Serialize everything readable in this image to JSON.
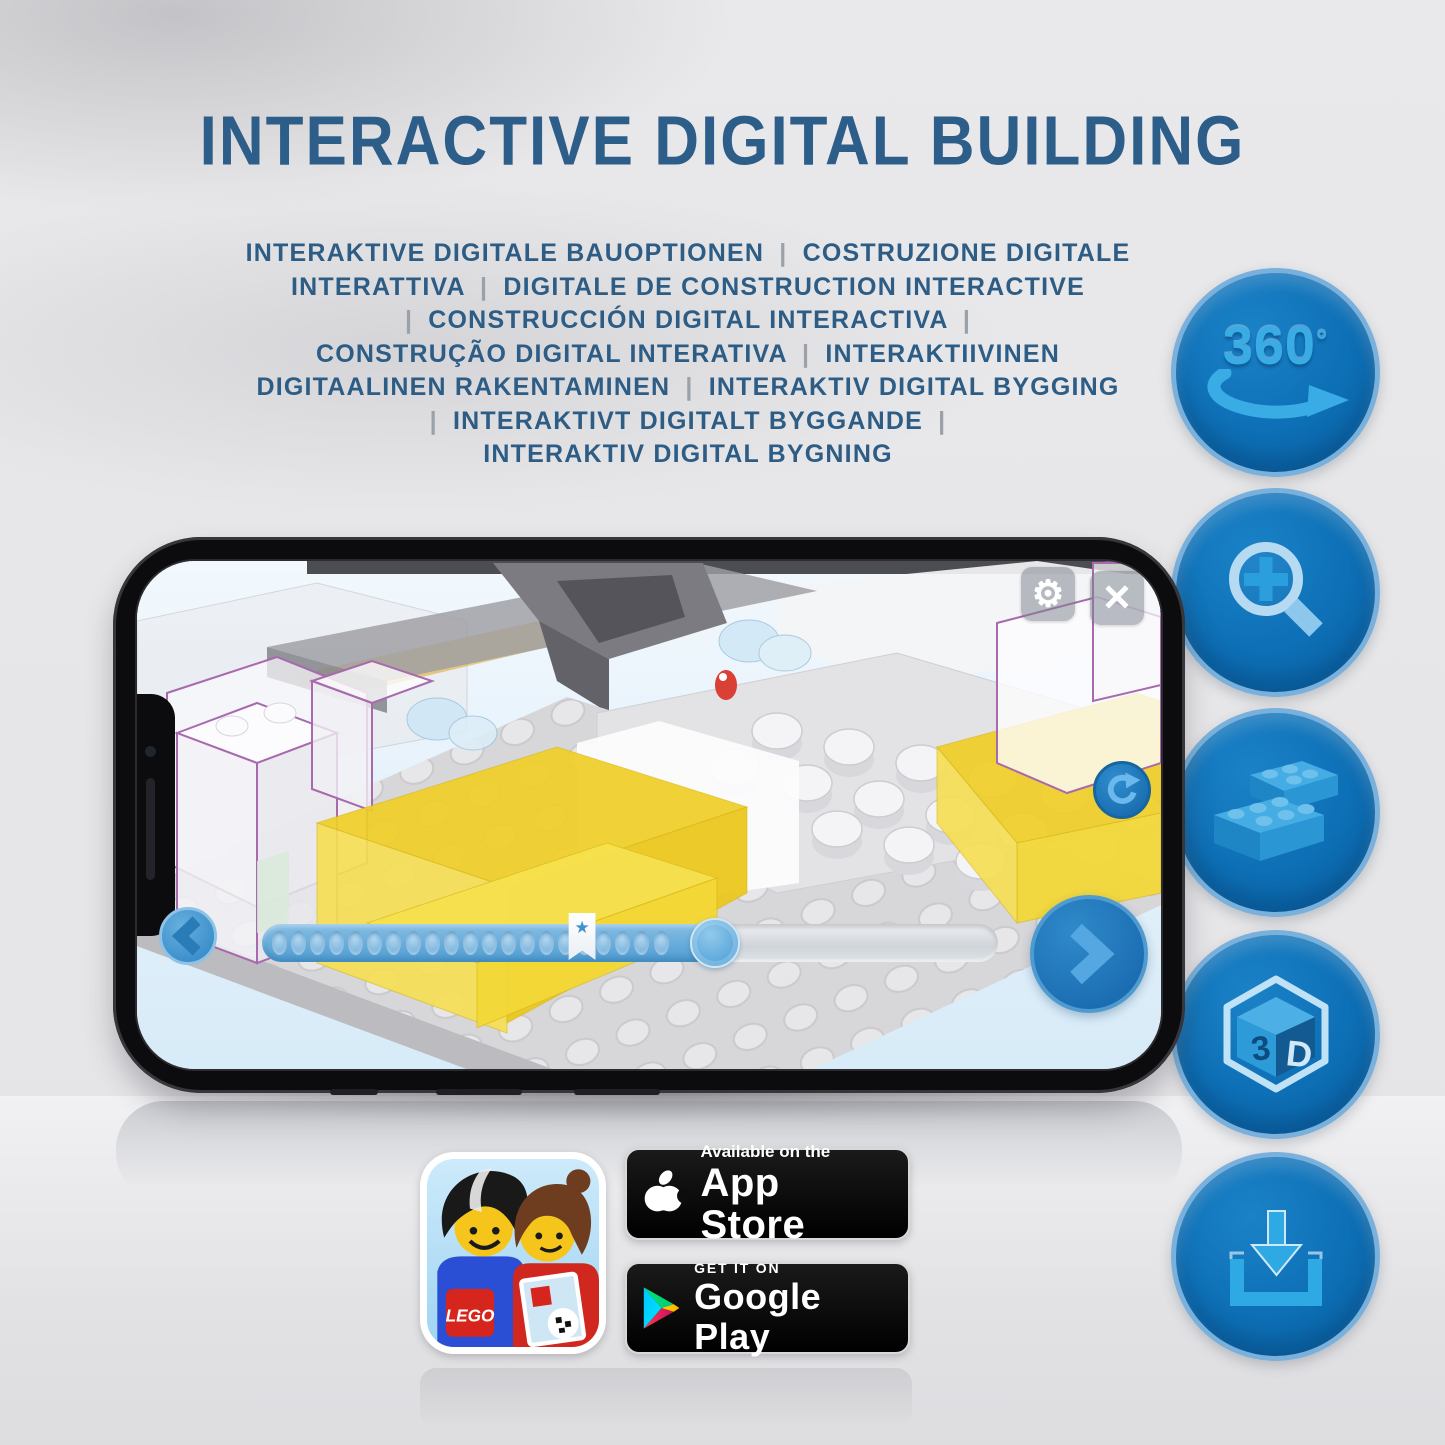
{
  "title": "INTERACTIVE DIGITAL BUILDING",
  "subtitle": {
    "lines": [
      "INTERAKTIVE DIGITALE BAUOPTIONEN | COSTRUZIONE DIGITALE",
      "INTERATTIVA | DIGITALE DE CONSTRUCTION INTERACTIVE",
      "| CONSTRUCCIÓN DIGITAL INTERACTIVA |",
      "CONSTRUÇÃO DIGITAL INTERATIVA | INTERAKTIIVINEN",
      "DIGITAALINEN RAKENTAMINEN | INTERAKTIV DIGITAL BYGGING",
      "| INTERAKTIVT DIGITALT BYGGANDE |",
      "INTERAKTIV DIGITAL BYGNING"
    ]
  },
  "features": [
    {
      "id": "360-rotation",
      "glyph": "360",
      "sup": "°"
    },
    {
      "id": "zoom-in-magnifier"
    },
    {
      "id": "brick-building"
    },
    {
      "id": "3d-view",
      "left": "3",
      "right": "D"
    },
    {
      "id": "download"
    }
  ],
  "phone": {
    "screen": {
      "settings_glyph": "⚙",
      "close_glyph": "✕",
      "progress": {
        "dot_count": 21,
        "fill_percent": 61.5,
        "bookmark_percent": 43.5,
        "star": "★"
      }
    }
  },
  "store_badges": {
    "lego_app": {
      "logo_text": "LEGO"
    },
    "app_store": {
      "tagline": "Available on the",
      "store": "App Store"
    },
    "google_play": {
      "tagline": "GET IT ON",
      "store": "Google Play"
    }
  },
  "colors": {
    "title_blue": "#2d5e89",
    "circle_blue": "#0d6fb5",
    "glyph_blue": "#39ace6",
    "app_accent_blue": "#1b6db1",
    "lego_yellow": "#f0cf28",
    "outline_purple": "#a869ae"
  }
}
